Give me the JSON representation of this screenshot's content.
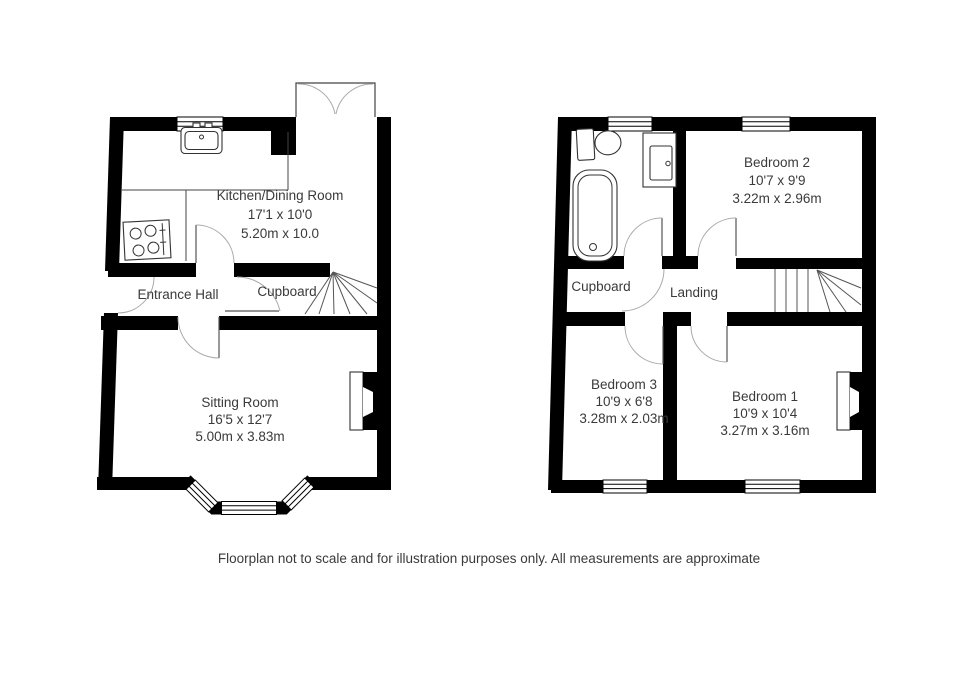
{
  "meta": {
    "background_color": "#ffffff",
    "wall_color": "#000000",
    "door_arc_color": "#aaaaaa",
    "text_color": "#3a3a3a"
  },
  "ground_floor": {
    "kitchen": {
      "name": "Kitchen/Dining Room",
      "imperial": "17'1 x 10'0",
      "metric": "5.20m x 10.0"
    },
    "entrance_hall": {
      "name": "Entrance Hall"
    },
    "cupboard": {
      "name": "Cupboard"
    },
    "sitting_room": {
      "name": "Sitting Room",
      "imperial": "16'5 x 12'7",
      "metric": "5.00m x 3.83m"
    }
  },
  "first_floor": {
    "bedroom2": {
      "name": "Bedroom 2",
      "imperial": "10'7 x 9'9",
      "metric": "3.22m x 2.96m"
    },
    "cupboard": {
      "name": "Cupboard"
    },
    "landing": {
      "name": "Landing"
    },
    "bedroom3": {
      "name": "Bedroom 3",
      "imperial": "10'9 x 6'8",
      "metric": "3.28m x 2.03m"
    },
    "bedroom1": {
      "name": "Bedroom 1",
      "imperial": "10'9 x 10'4",
      "metric": "3.27m x 3.16m"
    }
  },
  "caption": "Floorplan not to scale and for illustration purposes only. All measurements are approximate"
}
